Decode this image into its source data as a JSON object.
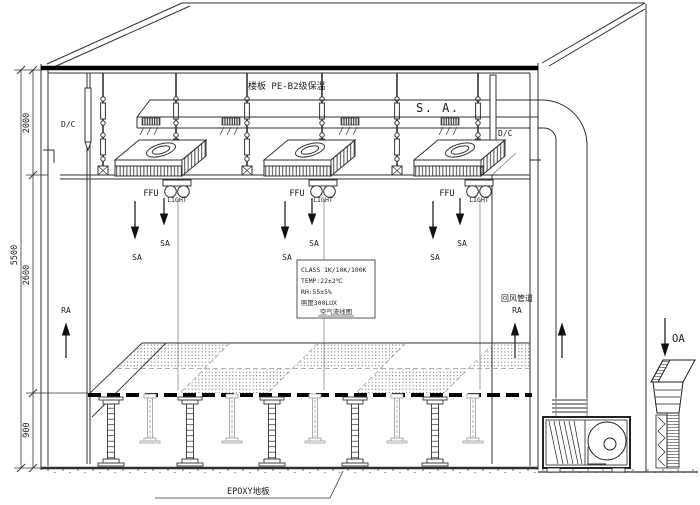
{
  "labels": {
    "slab": "楼板 PE-B2级保温",
    "supply_air": "S. A.",
    "dc_left": "D/C",
    "dc_right": "D/C",
    "ffu_labels": [
      "FFU",
      "FFU",
      "FFU"
    ],
    "light_labels": [
      "LIGHT",
      "LIGHT",
      "LIGHT"
    ],
    "sa_labels": [
      "SA",
      "SA",
      "SA",
      "SA",
      "SA",
      "SA"
    ],
    "ra_left": "RA",
    "return_duct_name": "回风管道",
    "ra_right": "RA",
    "oa": "OA",
    "epoxy_floor": "EPOXY地板"
  },
  "spec_box": {
    "class_line": "CLASS 1K/10K/100K",
    "temp_line": "TEMP:22±2℃",
    "rh_line": "RH:55±5%",
    "lux_line": "照度300LUX",
    "caption": "空气流线图"
  },
  "dimensions": {
    "total_height": "5500",
    "ceiling_plenum": "2000",
    "room_height": "2600",
    "raised_floor": "900"
  }
}
